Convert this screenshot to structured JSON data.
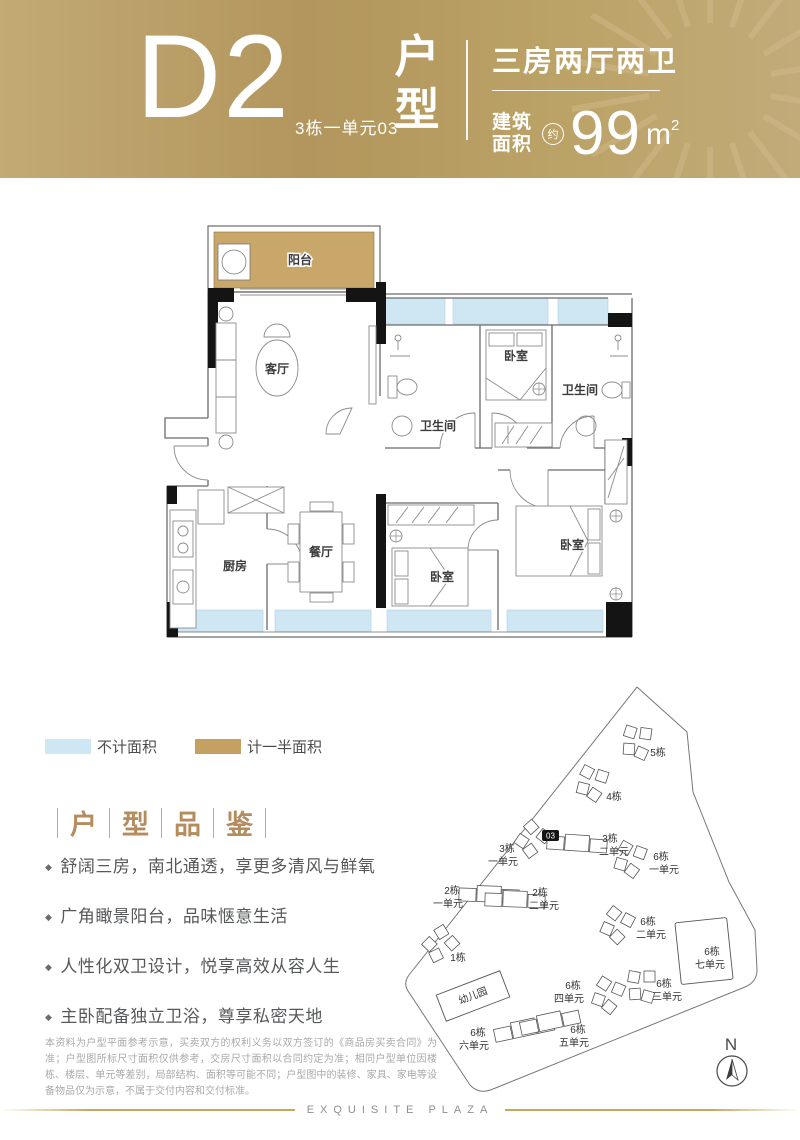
{
  "header": {
    "unit_code": "D2",
    "unit_sub": "3栋一单元03",
    "vertical_title_1": "户",
    "vertical_title_2": "型",
    "layout_desc": "三房两厅两卫",
    "area_label_1": "建筑",
    "area_label_2": "面积",
    "approx": "约",
    "area_value": "99",
    "area_unit": "m",
    "area_exp": "2"
  },
  "floorplan": {
    "rooms": {
      "balcony": "阳台",
      "living": "客厅",
      "bath1": "卫生间",
      "bed_top": "卧室",
      "bath2": "卫生间",
      "kitchen": "厨房",
      "dining": "餐厅",
      "bed_mid": "卧室",
      "bed_master": "卧室"
    }
  },
  "legend": {
    "no_area_label": "不计面积",
    "half_area_label": "计一半面积"
  },
  "colors": {
    "accent_gold": "#b2975f",
    "window_blue": "#cfe7f3",
    "balcony_tan": "#c9a66a",
    "title_bronze": "#b58c5e"
  },
  "selling": {
    "bullet_icon": "◆",
    "title_chars": [
      "户",
      "型",
      "品",
      "鉴"
    ],
    "items": [
      "舒阔三房，南北通透，享更多清风与鲜氧",
      "广角瞰景阳台，品味惬意生活",
      "人性化双卫设计，悦享高效从容人生",
      "主卧配备独立卫浴，尊享私密天地"
    ]
  },
  "sitemap": {
    "marker": "03",
    "compass": "N",
    "buildings": [
      {
        "l1": "5栋",
        "l2": ""
      },
      {
        "l1": "4栋",
        "l2": ""
      },
      {
        "l1": "3栋",
        "l2": "一单元"
      },
      {
        "l1": "3栋",
        "l2": "二单元"
      },
      {
        "l1": "6栋",
        "l2": "一单元"
      },
      {
        "l1": "2栋",
        "l2": "一单元"
      },
      {
        "l1": "2栋",
        "l2": "二单元"
      },
      {
        "l1": "6栋",
        "l2": "二单元"
      },
      {
        "l1": "6栋",
        "l2": "七单元"
      },
      {
        "l1": "1栋",
        "l2": ""
      },
      {
        "l1": "幼儿园",
        "l2": ""
      },
      {
        "l1": "6栋",
        "l2": "四单元"
      },
      {
        "l1": "6栋",
        "l2": "三单元"
      },
      {
        "l1": "6栋",
        "l2": "六单元"
      },
      {
        "l1": "6栋",
        "l2": "五单元"
      }
    ]
  },
  "disclaimer": "本资料为户型平面参考示意，买卖双方的权利义务以双方签订的《商品房买卖合同》为准；户型图所标尺寸面积仅供参考，交房尺寸面积以合同约定为准；相同户型单位因楼栋、楼层、单元等差别，局部结构、面积等可能不同；户型图中的装修、家具、家电等设备物品仅为示意，不属于交付内容和交付标准。",
  "footer": {
    "brand": "EXQUISITE PLAZA"
  }
}
